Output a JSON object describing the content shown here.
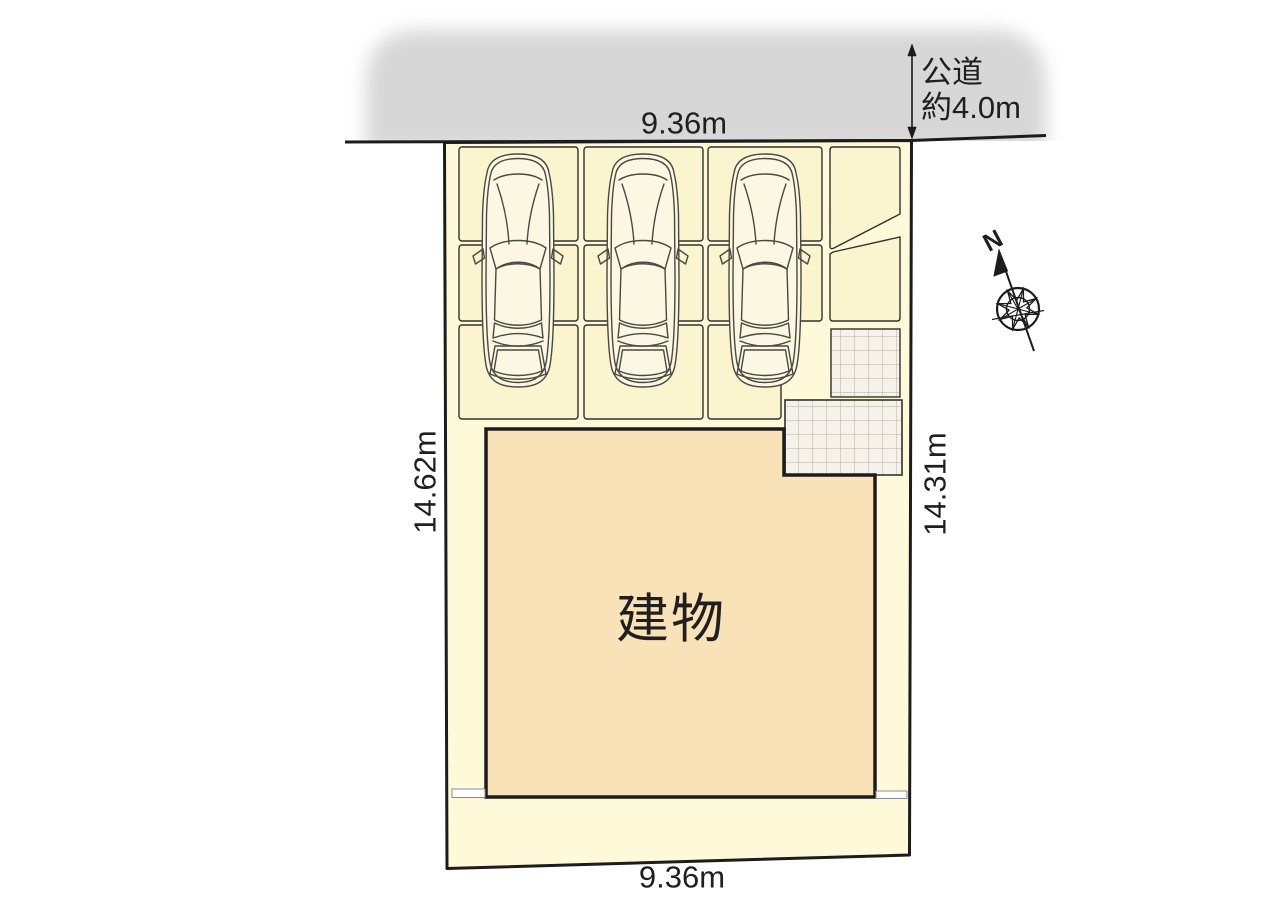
{
  "plan": {
    "labels": {
      "building": "建物",
      "road_line1": "公道",
      "road_line2": "約4.0m",
      "dim_top": "9.36m",
      "dim_bottom": "9.36m",
      "dim_left": "14.62m",
      "dim_right": "14.31m",
      "compass_north": "N"
    },
    "parking": {
      "stall_count": 9,
      "car_count": 3
    },
    "colors": {
      "road": "#d7d7d7",
      "lot": "#fdf9d9",
      "stall": "#faf4cf",
      "building": "#f9e1b8",
      "grid-bg": "#f4f2ea",
      "grid-line": "#b3af9f",
      "outline": "#1c1c1c",
      "thin-line": "#33312c",
      "car-line": "#4a4840",
      "car-fill": "#fbf7e2",
      "text": "#1f1f1f"
    }
  }
}
